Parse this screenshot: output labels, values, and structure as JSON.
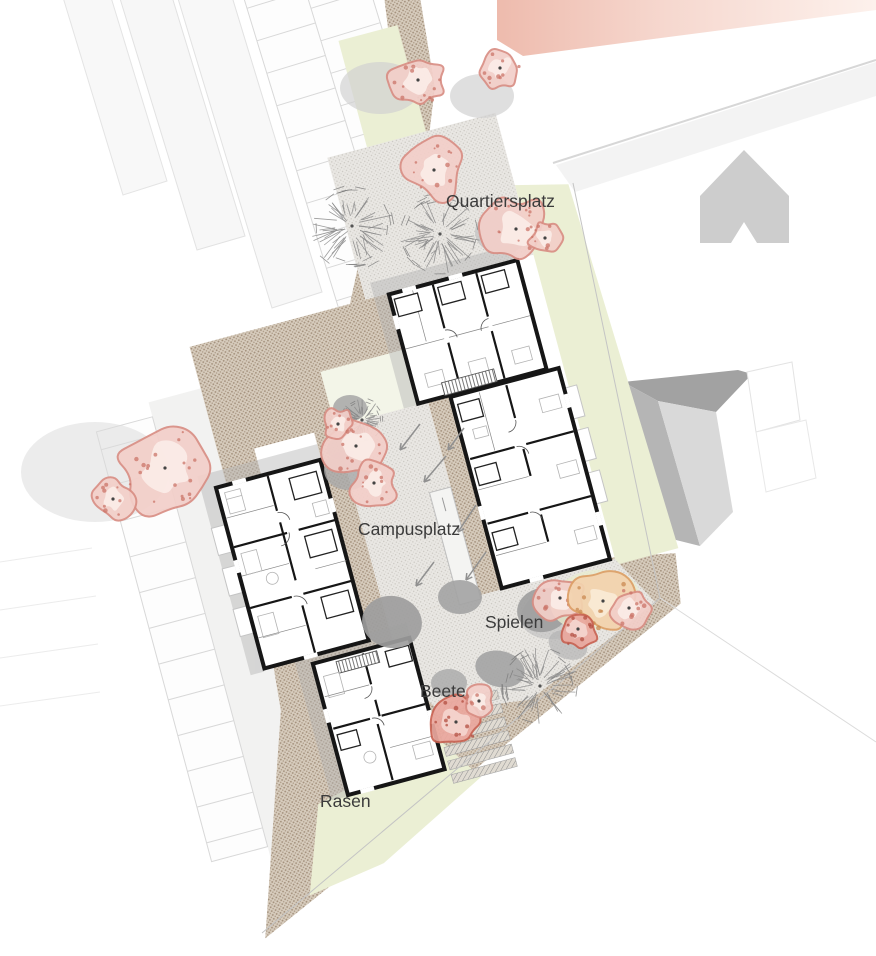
{
  "title": "Campus site plan (ground floor)",
  "labels": {
    "quartiersplatz": "Quartiersplatz",
    "campusplatz": "Campusplatz",
    "spielen": "Spielen",
    "beete": "Beete",
    "rasen": "Rasen"
  },
  "colors": {
    "path_brown": "#d7ccbd",
    "path_dot": "#9b8772",
    "plaza_gray": "#e9e7e3",
    "plaza_dot": "#c6c3bd",
    "green": "#ebefd4",
    "green_soft": "#f3f5e8",
    "blossom_pink": "#f3cfc9",
    "blossom_edge": "#d98e84",
    "wall_black": "#161616",
    "context_gray": "#cccccc",
    "blob_gray": "#9c9c9c",
    "shadow_gray": "#b4b4b4",
    "red_band": "#eebbad",
    "boundary_gray": "#c4c4c4",
    "tree_stroke": "#8a8a8a",
    "label_text": "#3b3b3b"
  }
}
